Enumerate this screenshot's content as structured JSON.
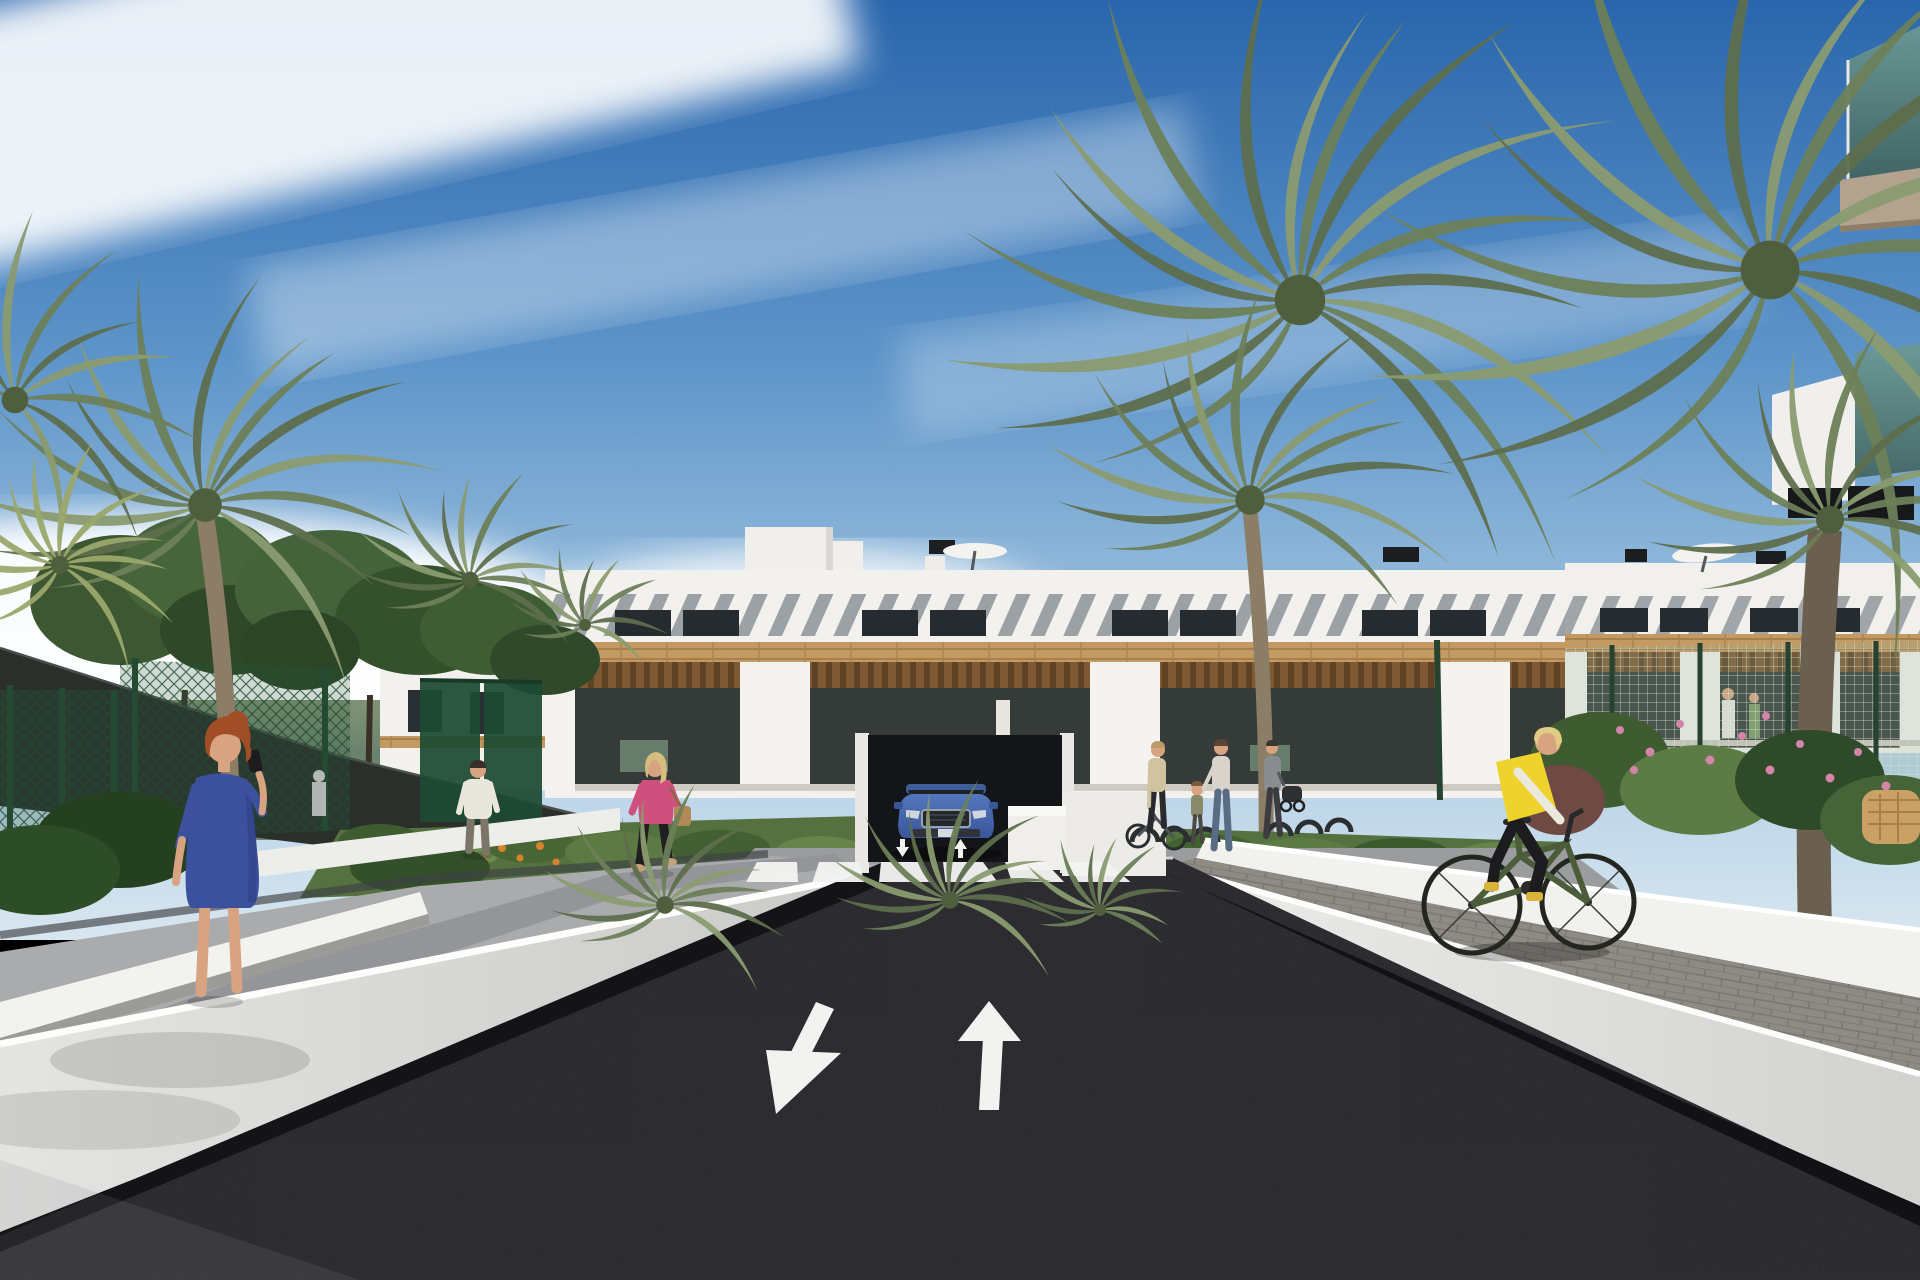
{
  "scene": {
    "description": "Sunny 3D architectural render of a modern white Mediterranean apartment complex with wooden pergola terraces, palm trees, a dark asphalt access road with two white lane arrows and a zebra crossing, a blue SUV at a garage ramp, pedestrians on side paths and a cyclist in a yellow vest riding along the right wall",
    "palette": {
      "sky_top": "#2a66ac",
      "sky_mid": "#5d94c9",
      "sky_low": "#a7c8e2",
      "sky_horizon": "#d8e6f0",
      "cloud": "#ffffff",
      "building_white": "#f2f1ee",
      "slat_gray": "#7b828a",
      "window_dark": "#262b2f",
      "wood": "#c49a63",
      "pergola": "#7d5a33",
      "glass_dark": "#353b39",
      "glass_teal": "#5f8a82",
      "soffit_tan": "#b3a28e",
      "foliage_dark": "#35502c",
      "foliage_mid": "#4a6739",
      "foliage_light": "#71935c",
      "palm_green": "#6d7f58",
      "palm_dark": "#5e6e4d",
      "palm_light": "#8a9b70",
      "fence_green": "#1f4a30",
      "mesh_green": "#d8e6d4",
      "grass": "#55713f",
      "flower_orange": "#d9822b",
      "flower_pink": "#d285a8",
      "wall_white": "#ebebe8",
      "bank_gray": "#a9abad",
      "path_gray": "#939598",
      "paver_gray": "#8e8b85",
      "asphalt": "#232327",
      "marking": "#f2f2f1",
      "car_blue": "#4c70b0",
      "car_glass": "#1d2227",
      "skin": "#d8a381",
      "hair_red": "#a14e27",
      "dress_blue": "#3c519e",
      "hair_blonde": "#d6bd7d",
      "jacket_pink": "#cf4f7d",
      "bag_tan": "#b18a56",
      "tee_white": "#e9e6dc",
      "vest_yellow": "#eed32f",
      "bike_green": "#4b5c3b",
      "shoe_yellow": "#d9b43a"
    },
    "buildings": [
      {
        "name": "central-block",
        "floors": 3,
        "features": "white parapet, diagonal slat sun-shades, dark windows, timber cladding band, pergola terraces, rooftop stair tower, black vents, white parasol"
      },
      {
        "name": "right-block",
        "features": "same style, farther away, green mesh fence in front, rooftop parasol, two people on terrace"
      },
      {
        "name": "foreground-balcony-corner",
        "features": "teal glass balustrade balconies with tan soffit, top right corner"
      }
    ],
    "road": {
      "surface": "dark asphalt",
      "lane_arrows": [
        {
          "direction": "down-left"
        },
        {
          "direction": "up"
        }
      ],
      "crosswalk": {
        "count": 6,
        "top_y": 862,
        "bot_y": 882,
        "top_x0": 757,
        "top_dx": 62,
        "top_w": 40,
        "bot_x0": 746,
        "bot_dx": 66.5,
        "bot_w": 52
      },
      "mini_arrows": 2
    },
    "vehicles": [
      {
        "type": "suv",
        "color": "blue",
        "position": "garage ramp at building center"
      }
    ],
    "people": [
      {
        "id": "redhead-blue-dress",
        "desc": "red-haired woman in blue patterned dress talking on phone, left path"
      },
      {
        "id": "man-white-shirt",
        "desc": "man in white t-shirt walking away on left path"
      },
      {
        "id": "woman-pink-jacket",
        "desc": "blonde woman in pink jacket, black trousers, tan handbag"
      },
      {
        "id": "woman-with-bike",
        "desc": "woman pushing bicycle near building entrance"
      },
      {
        "id": "woman-with-child",
        "desc": "woman holding child's hand on sidewalk"
      },
      {
        "id": "person-with-stroller",
        "desc": "person pushing stroller near bike racks"
      },
      {
        "id": "cyclist-yellow-vest",
        "desc": "blonde cyclist in yellow vest on dark green bicycle, right paver path"
      },
      {
        "id": "tennis-player",
        "desc": "faint figure behind green court fence, left"
      },
      {
        "id": "terrace-pair",
        "desc": "two small figures on right block terrace"
      }
    ],
    "bike_racks": [
      [
        1132,
        842,
        13
      ],
      [
        1162,
        842,
        13
      ],
      [
        1192,
        842,
        13
      ],
      [
        1267,
        836,
        12
      ],
      [
        1297,
        834,
        12
      ],
      [
        1327,
        832,
        12
      ]
    ],
    "palms": [
      {
        "cx": 1300,
        "cy": 300,
        "len": 360,
        "n": 17,
        "a0": -230,
        "a1": 50,
        "front": false
      },
      {
        "cx": 1770,
        "cy": 270,
        "len": 420,
        "n": 16,
        "a0": -240,
        "a1": 60,
        "front": false
      },
      {
        "cx": 1250,
        "cy": 500,
        "len": 210,
        "n": 13,
        "a0": -210,
        "a1": 30,
        "front": false,
        "trunk": {
          "x1": 1250,
          "y1": 510,
          "x2": 1266,
          "y2": 860,
          "w": 15
        }
      },
      {
        "cx": 205,
        "cy": 505,
        "len": 240,
        "n": 15,
        "a0": -220,
        "a1": 40,
        "front": false,
        "trunk": {
          "x1": 205,
          "y1": 515,
          "x2": 232,
          "y2": 840,
          "w": 18
        }
      },
      {
        "cx": 15,
        "cy": 400,
        "len": 190,
        "n": 9,
        "a0": -140,
        "a1": 60,
        "front": false
      },
      {
        "cx": 60,
        "cy": 565,
        "len": 130,
        "n": 12,
        "a0": -230,
        "a1": 50,
        "front": false,
        "light": true
      },
      {
        "cx": 470,
        "cy": 580,
        "len": 120,
        "n": 11,
        "a0": -210,
        "a1": 30,
        "front": false
      },
      {
        "cx": 585,
        "cy": 625,
        "len": 85,
        "n": 9,
        "a0": -200,
        "a1": 20,
        "front": false
      },
      {
        "cx": 1830,
        "cy": 520,
        "len": 200,
        "n": 12,
        "a0": -220,
        "a1": 40,
        "front": false,
        "trunk": {
          "x1": 1825,
          "y1": 530,
          "x2": 1815,
          "y2": 930,
          "w": 34,
          "dark": true
        }
      },
      {
        "cx": 665,
        "cy": 905,
        "len": 125,
        "n": 12,
        "a0": -215,
        "a1": 35,
        "front": true
      },
      {
        "cx": 950,
        "cy": 900,
        "len": 125,
        "n": 12,
        "a0": -210,
        "a1": 30,
        "front": true
      },
      {
        "cx": 1100,
        "cy": 910,
        "len": 85,
        "n": 10,
        "a0": -205,
        "a1": 25,
        "front": true
      }
    ]
  }
}
